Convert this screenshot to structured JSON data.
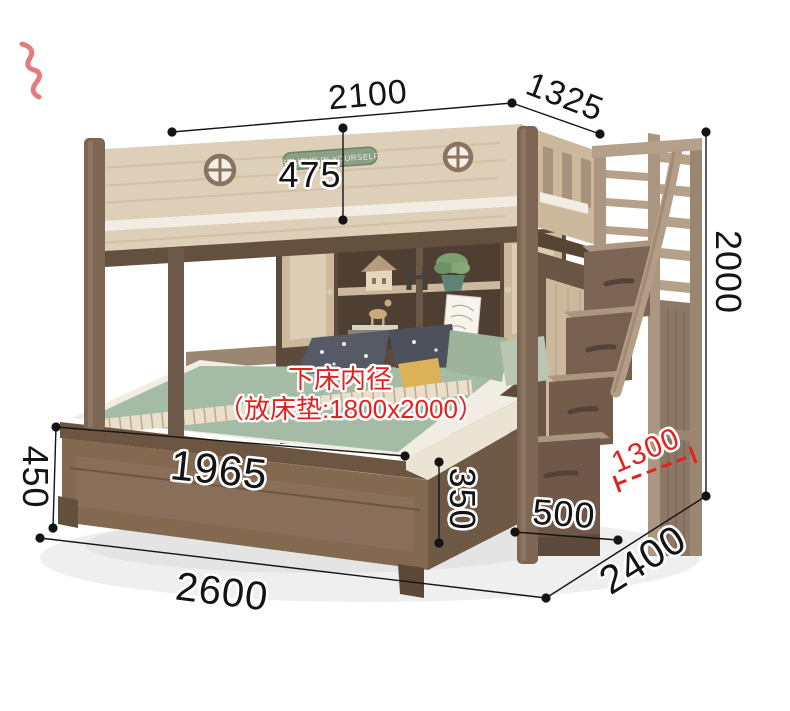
{
  "note": {
    "line1": "下床内径",
    "line2": "（放床垫:1800x2000）",
    "color": "#e61f1f"
  },
  "decor": {
    "plaque_text": "BELIEVE IN YOURSELF",
    "shelf_letter": "H"
  },
  "colors": {
    "dim": "#141414",
    "red": "#e61f1f",
    "wood_light": "#decfb8",
    "wood_mid": "#cbb89d",
    "post": "#7d6654",
    "walnut": "#82694f",
    "walnut_dark": "#63503f",
    "walnut_mid": "#6e5947",
    "mattress": "#f2ede2",
    "blanket": "#a4bba5",
    "stripe": "#eadfca",
    "pillow_dark": "#555a65",
    "pillow_dark2": "#4c515b",
    "pillow_green": "#9db39c",
    "pillow_yellow": "#ddb158",
    "plaque": "#8ba086",
    "stair_wood": "#ab9681",
    "stair_face": "#7c6555"
  },
  "dimensions": [
    {
      "name": "upper-bed-length",
      "value": "2100",
      "x1": 172,
      "y1": 132,
      "x2": 512,
      "y2": 103,
      "dots": [
        [
          172,
          132
        ],
        [
          512,
          103
        ]
      ],
      "label": {
        "x": 368,
        "y": 95,
        "rot": -5,
        "size": 34
      }
    },
    {
      "name": "upper-bed-width",
      "value": "1325",
      "x1": 512,
      "y1": 103,
      "x2": 600,
      "y2": 134,
      "dots": [
        [
          600,
          134
        ]
      ],
      "label": {
        "x": 565,
        "y": 97,
        "rot": 21,
        "size": 34
      }
    },
    {
      "name": "guardrail-height",
      "value": "475",
      "x1": 343,
      "y1": 128,
      "x2": 343,
      "y2": 220,
      "dots": [
        [
          343,
          128
        ],
        [
          343,
          220
        ]
      ],
      "label": {
        "x": 310,
        "y": 175,
        "rot": 0,
        "size": 36
      }
    },
    {
      "name": "overall-height",
      "value": "2000",
      "x1": 706,
      "y1": 132,
      "x2": 706,
      "y2": 496,
      "dots": [
        [
          706,
          132
        ],
        [
          706,
          496
        ]
      ],
      "label": {
        "x": 728,
        "y": 272,
        "rot": 90,
        "size": 36
      }
    },
    {
      "name": "footboard-height",
      "value": "450",
      "x1": 56,
      "y1": 427,
      "x2": 53,
      "y2": 528,
      "dots": [
        [
          56,
          427
        ],
        [
          53,
          528
        ]
      ],
      "label": {
        "x": 35,
        "y": 477,
        "rot": 90,
        "size": 36
      }
    },
    {
      "name": "lower-bed-length",
      "value": "1965",
      "x1": 56,
      "y1": 427,
      "x2": 405,
      "y2": 456,
      "dots": [
        [
          405,
          456
        ]
      ],
      "label": {
        "x": 219,
        "y": 470,
        "rot": 6,
        "size": 42
      }
    },
    {
      "name": "bed-base-height",
      "value": "350",
      "x1": 439,
      "y1": 462,
      "x2": 439,
      "y2": 543,
      "dots": [
        [
          439,
          462
        ],
        [
          439,
          543
        ]
      ],
      "label": {
        "x": 462,
        "y": 499,
        "rot": 90,
        "size": 36
      }
    },
    {
      "name": "stair-depth",
      "value": "500",
      "x1": 515,
      "y1": 532,
      "x2": 618,
      "y2": 540,
      "dots": [
        [
          515,
          532
        ],
        [
          618,
          540
        ]
      ],
      "label": {
        "x": 564,
        "y": 514,
        "rot": 4,
        "size": 36
      }
    },
    {
      "name": "stair-height",
      "value": "1300",
      "x1": 617,
      "y1": 484,
      "x2": 693,
      "y2": 455,
      "color": "#e61f1f",
      "dashed": true,
      "ticks": [
        [
          [
            620,
            492
          ],
          [
            614,
            476
          ]
        ],
        [
          [
            696,
            463
          ],
          [
            690,
            447
          ]
        ]
      ],
      "label": {
        "x": 646,
        "y": 451,
        "rot": -23,
        "size": 30
      }
    },
    {
      "name": "overall-length",
      "value": "2600",
      "x1": 40,
      "y1": 538,
      "x2": 546,
      "y2": 598,
      "dots": [
        [
          40,
          538
        ],
        [
          546,
          598
        ]
      ],
      "label": {
        "x": 222,
        "y": 592,
        "rot": 7,
        "size": 40
      }
    },
    {
      "name": "overall-width",
      "value": "2400",
      "x1": 546,
      "y1": 598,
      "x2": 706,
      "y2": 496,
      "dots": [],
      "label": {
        "x": 643,
        "y": 560,
        "rot": -32,
        "size": 40
      }
    }
  ]
}
